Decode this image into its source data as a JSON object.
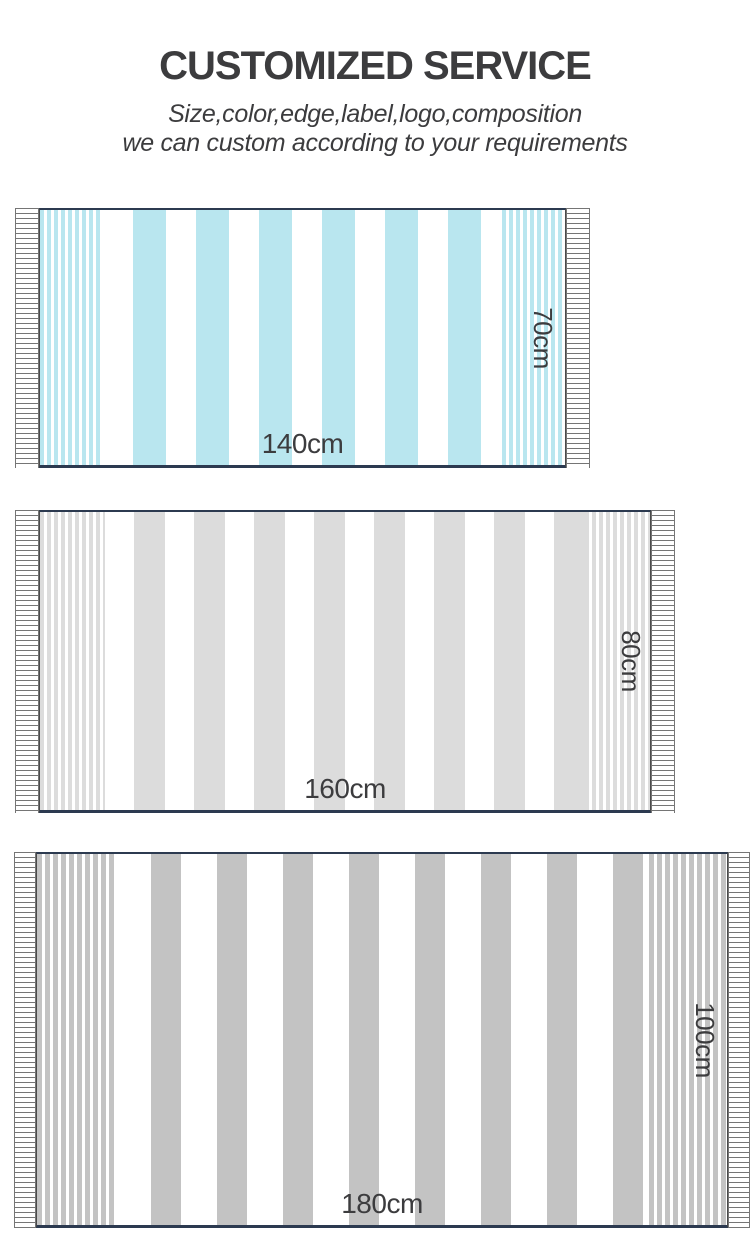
{
  "page": {
    "title": "CUSTOMIZED SERVICE",
    "subtitle_line1": "Size,color,edge,label,logo,composition",
    "subtitle_line2": "we can custom according to your requirements"
  },
  "towels": [
    {
      "id": "towel-140x70",
      "width_label": "140cm",
      "height_label": "70cm",
      "stripe_color": "#b9e6ef"
    },
    {
      "id": "towel-160x80",
      "width_label": "160cm",
      "height_label": "80cm",
      "stripe_color": "#dcdcdc"
    },
    {
      "id": "towel-180x100",
      "width_label": "180cm",
      "height_label": "100cm",
      "stripe_color": "#c3c3c3"
    }
  ],
  "colors": {
    "text": "#3c3c3e",
    "towel_hem_border": "#2c3a50",
    "fringe_line": "#757575",
    "background": "#ffffff"
  }
}
